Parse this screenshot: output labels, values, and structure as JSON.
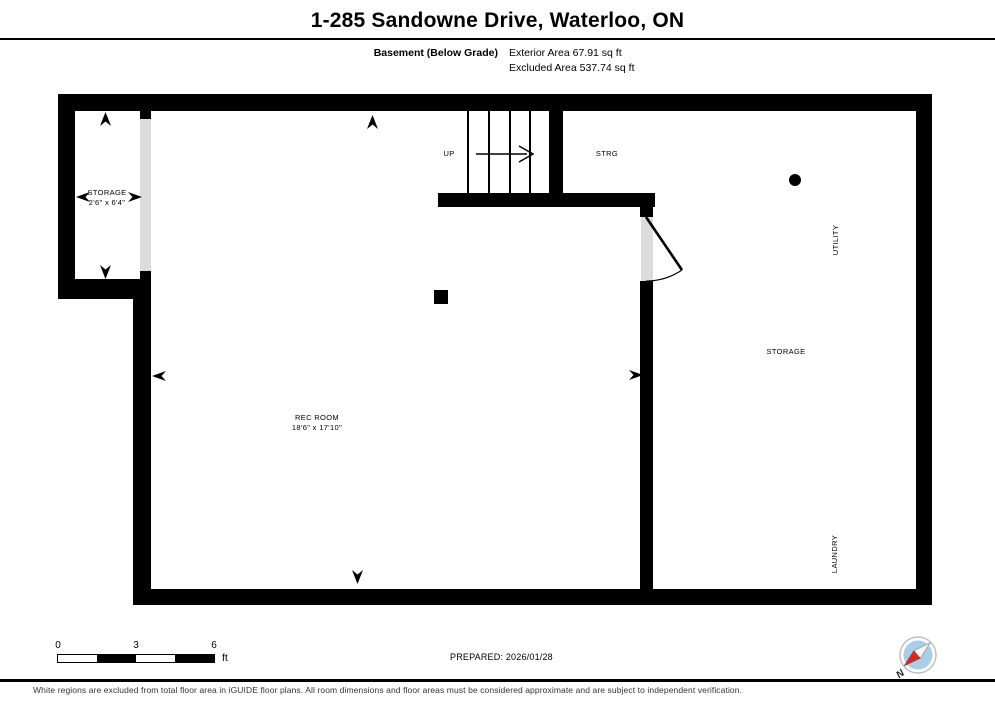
{
  "header": {
    "title": "1-285 Sandowne Drive, Waterloo, ON",
    "floor_label": "Basement (Below Grade)",
    "exterior_area": "Exterior Area 67.91 sq ft",
    "excluded_area": "Excluded Area 537.74 sq ft"
  },
  "plan": {
    "storage_left": {
      "name": "STORAGE",
      "dims": "2'6\" x 6'4\""
    },
    "rec_room": {
      "name": "REC ROOM",
      "dims": "18'6\" x 17'10\""
    },
    "stairs_label": "UP",
    "strg_label": "STRG",
    "utility_label": "UTILITY",
    "storage_right_label": "STORAGE",
    "laundry_label": "LAUNDRY"
  },
  "footer": {
    "scale_ticks": [
      "0",
      "3",
      "6"
    ],
    "scale_unit": "ft",
    "prepared": "PREPARED: 2026/01/28",
    "disclaimer": "White regions are excluded from total floor area in iGUIDE floor plans. All room dimensions and floor areas must be considered approximate and are subject to independent verification.",
    "compass_north": "N"
  },
  "colors": {
    "wall": "#000000",
    "opening": "#dcdcdc",
    "compass_blue": "#a9cfe8",
    "compass_red": "#cf2b24",
    "compass_ring": "#c0c0c0"
  }
}
